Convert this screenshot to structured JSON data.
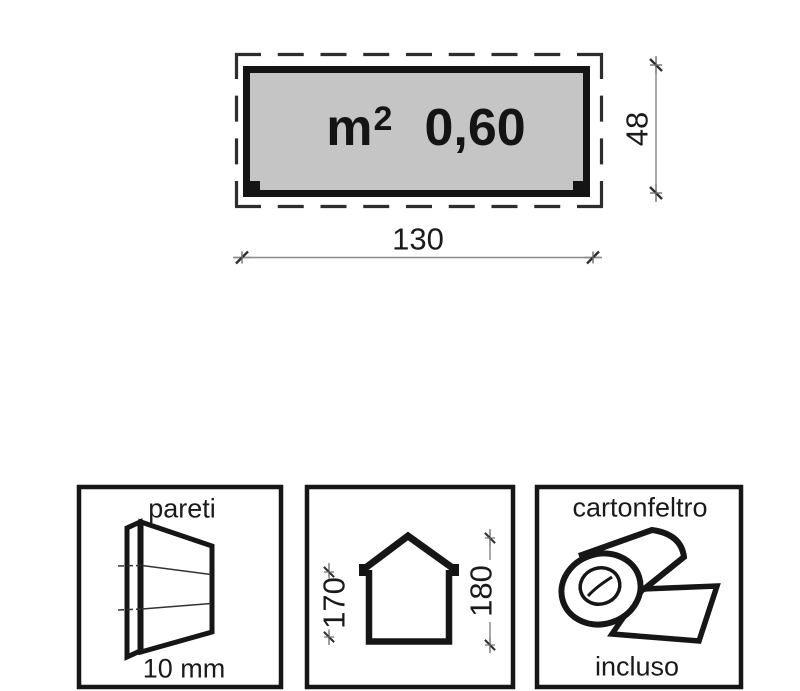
{
  "plan": {
    "unit_base": "m",
    "unit_exponent": "2",
    "area_value": "0,60",
    "width_dim": "130",
    "depth_dim": "48",
    "floor_fill_color": "#c5c5c5",
    "outline_color": "#141414",
    "dimension_line_color": "#8a8a8a"
  },
  "spec_boxes": {
    "walls": {
      "title": "pareti",
      "value": "10 mm",
      "icon": "wall-panels-icon"
    },
    "heights": {
      "eaves_dim": "170",
      "ridge_dim": "180",
      "icon": "house-outline-icon"
    },
    "roof_felt": {
      "title": "cartonfeltro",
      "value": "incluso",
      "icon": "felt-roll-icon"
    }
  }
}
